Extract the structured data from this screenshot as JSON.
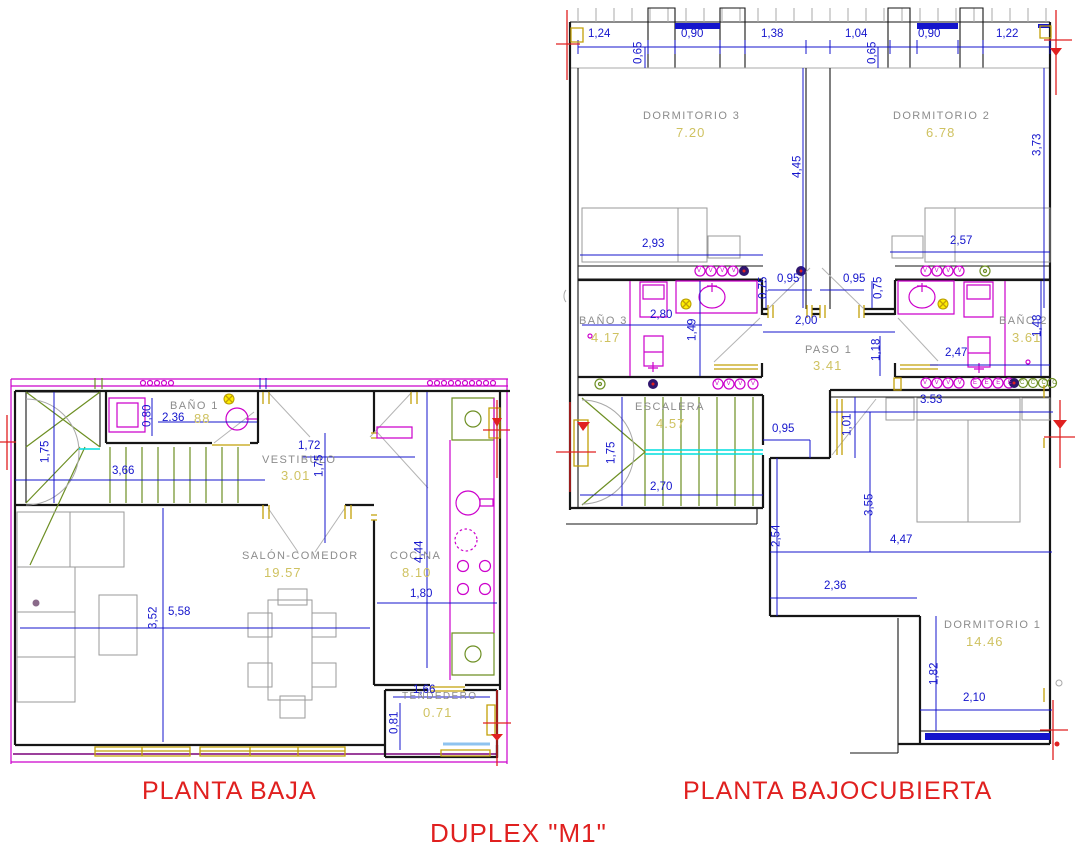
{
  "title": "DUPLEX \"M1\"",
  "colors": {
    "dimension_blue": "#1414cc",
    "area_khaki": "#cfc261",
    "room_gray": "#8c8c8c",
    "caption_red": "#e0201f",
    "fixture_magenta": "#cc00cc",
    "finish_yellow": "#c2a008",
    "stair_green": "#6d8f23"
  },
  "planta_baja": {
    "caption": "PLANTA BAJA",
    "rooms": {
      "banio1": {
        "name": "BAÑO 1",
        "area": "88",
        "width_dim": "2.36"
      },
      "vestibulo": {
        "name": "VESTIBULO",
        "area": "3.01"
      },
      "salon": {
        "name": "SALÓN-COMEDOR",
        "area": "19.57"
      },
      "cocina": {
        "name": "COCINA",
        "area": "8.10"
      },
      "tendedero": {
        "name": "TENDEDERO",
        "area": "0.71"
      }
    },
    "dims": {
      "stair_height": "1,75",
      "stair_width": "3,66",
      "banio1_height": "0,80",
      "vestibulo_width": "1,72",
      "vestibulo_height": "1,75",
      "salon_height": "3,52",
      "salon_width": "5,58",
      "cocina_height": "4,44",
      "cocina_width": "1,80",
      "tendedero_width": "1,66",
      "tendedero_height": "0,81"
    }
  },
  "planta_bajocubierta": {
    "caption": "PLANTA BAJOCUBIERTA",
    "rooms": {
      "dormitorio3": {
        "name": "DORMITORIO 3",
        "area": "7.20"
      },
      "dormitorio2": {
        "name": "DORMITORIO 2",
        "area": "6.78"
      },
      "banio3": {
        "name": "BAÑO 3",
        "area": "4.17"
      },
      "paso1": {
        "name": "PASO 1",
        "area": "3.41"
      },
      "banio2": {
        "name": "BAÑO 2",
        "area": "3.61"
      },
      "escalera": {
        "name": "ESCALERA",
        "area": "4.57"
      },
      "dormitorio1": {
        "name": "DORMITORIO 1",
        "area": "14.46"
      }
    },
    "top_dims": [
      "1,24",
      "0,65",
      "0,90",
      "1,38",
      "1,04",
      "0,65",
      "0,90",
      "1,22"
    ],
    "dims": {
      "dorm3_width": "2,93",
      "dorm3_height": "4,45",
      "dorm2_width": "2,57",
      "dorm2_height": "3,73",
      "banio3_width": "2,80",
      "banio3_height": "1,49",
      "door_dorm3_jamb": "0,75",
      "door_dorm3": "0,95",
      "door_dorm2": "0,95",
      "door_dorm2_jamb": "0,75",
      "paso_width": "2,00",
      "paso_height": "1,18",
      "banio2_width": "2,47",
      "banio2_height": "1,48",
      "escalera_height": "1,75",
      "escalera_width": "2,70",
      "landing_width": "0,95",
      "dorm1_top_width": "3.53",
      "dorm1_notch_height": "1,01",
      "dorm1_mid_height": "3,55",
      "dorm1_left_height": "2,54",
      "dorm1_width": "4,47",
      "dorm1_lower_width": "2,36",
      "dorm1_bottom_height": "1,82",
      "dorm1_bottom_width": "2,10"
    },
    "symbols": {
      "row1_v": "VVVV",
      "row2_v": "VVVV",
      "row3_v": "VVV",
      "row3_v1": "V",
      "row4_v": "VVVV",
      "row4_e": "EEEE",
      "row4_c": "CCCC"
    }
  }
}
